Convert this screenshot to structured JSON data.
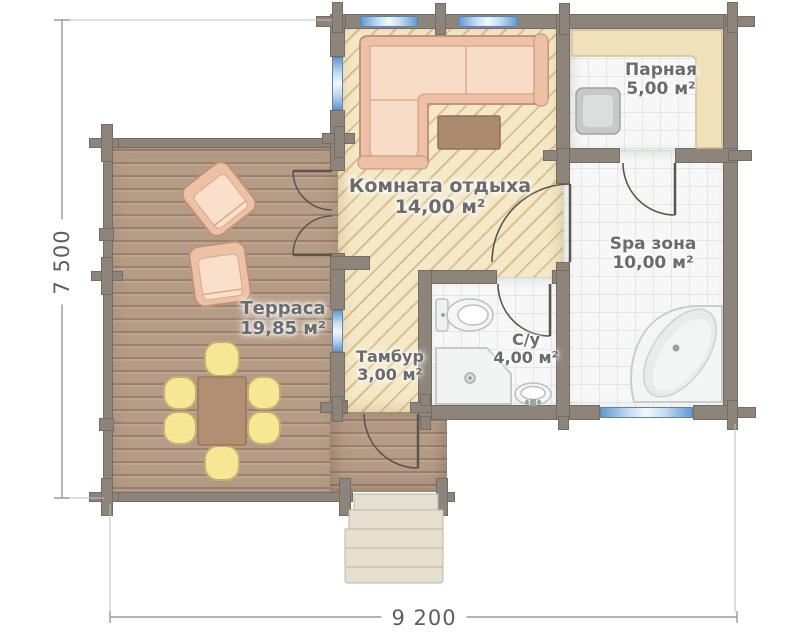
{
  "plan": {
    "title": "bathhouse-floor-plan",
    "rooms": [
      {
        "name": "Комната отдыха",
        "area": "14,00 м²"
      },
      {
        "name": "Парная",
        "area": "5,00 м²"
      },
      {
        "name": "Spa зона",
        "area": "10,00 м²"
      },
      {
        "name": "Терраса",
        "area": "19,85 м²"
      },
      {
        "name": "Тамбур",
        "area": "3,00 м²"
      },
      {
        "name": "С/у",
        "area": "4,00 м²"
      }
    ],
    "dimensions": {
      "height_label": "7 500",
      "width_label": "9 200"
    },
    "colors": {
      "wall": "#8d857b",
      "window": "#5e96cd",
      "hatch_floor": "#f4e8c6",
      "tile_floor": "#f6f7f6",
      "wood_floor": "#b59c87",
      "label_text": "#6b6b6b"
    },
    "furniture_icons": [
      "corner-sofa",
      "coffee-table",
      "sauna-bench",
      "sauna-stove",
      "corner-bathtub",
      "toilet",
      "shower-tray",
      "washbasin",
      "dining-table",
      "dining-chair",
      "armchair",
      "stairs"
    ]
  }
}
